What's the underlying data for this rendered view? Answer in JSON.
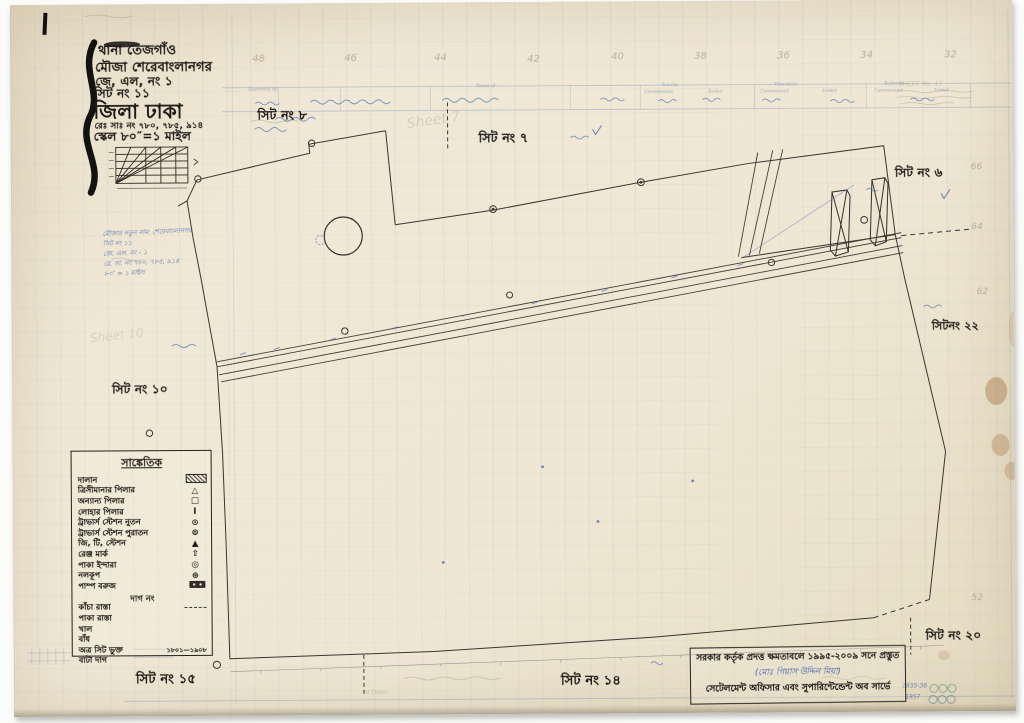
{
  "header": {
    "thana": "থানা তেজগাঁও",
    "mouza": "মৌজা শেরেবাংলানগর",
    "jl_no": "জে, এল, নং ১",
    "sheet_no": "সিট নং ১১",
    "district": "জিলা ঢাকা",
    "rs_no": "রেঃ সাঃ নং ৭৮০, ৭৮৫, ৯১৪",
    "scale": "স্কেল ৮০″=১ মাইল"
  },
  "sheet_labels": {
    "s8": "সিট নং ৮",
    "s7": "সিট নং ৭",
    "s6": "সিট নং ৬",
    "s22": "সিটনং ২২",
    "s10": "সিট নং ১০",
    "s20": "সিট নং ২০",
    "s15": "সিট নং ১৫",
    "s14": "সিট নং ১৪"
  },
  "grid_numbers": {
    "top": [
      "48",
      "46",
      "44",
      "42",
      "40",
      "38",
      "36",
      "34",
      "32"
    ],
    "right": [
      "66",
      "64",
      "62",
      "52"
    ]
  },
  "form_strip": {
    "labels": [
      "Examined by",
      "Name of",
      "Survey",
      "Khanapuri",
      "Bujharat",
      "Commenced",
      "Ended",
      "Commenced",
      "Ended",
      "Commenced",
      "Ended"
    ]
  },
  "legend": {
    "title": "সাঙ্কেতিক",
    "items": [
      {
        "label": "দালান",
        "sym": "hatch"
      },
      {
        "label": "ত্রিসীমানার পিলার",
        "sym": "△"
      },
      {
        "label": "অন্যান্য পিলার",
        "sym": "□"
      },
      {
        "label": "লোহার পিলার",
        "sym": "Ⅰ"
      },
      {
        "label": "ট্রাভার্স স্টেশন নুতন",
        "sym": "⊙"
      },
      {
        "label": "ট্রাভার্স স্টেশন পুরাতন",
        "sym": "⊚"
      },
      {
        "label": "জি, টি, স্টেশন",
        "sym": "▲"
      },
      {
        "label": "রেঞ্জ মার্ক",
        "sym": "⇧"
      },
      {
        "label": "পাকা ইন্দারা",
        "sym": "◎"
      },
      {
        "label": "নলকূপ",
        "sym": "⊛"
      },
      {
        "label": "পাম্প বরুজ",
        "sym": "pump"
      }
    ],
    "plot_heading": "দাগ নং",
    "line_items": [
      {
        "label": "কাঁচা রাস্তা",
        "value": ""
      },
      {
        "label": "পাকা রাস্তা",
        "value": ""
      },
      {
        "label": "খাল",
        "value": ""
      },
      {
        "label": "বাঁধ",
        "value": ""
      },
      {
        "label": "অত্র সিট ভুক্ত",
        "value": "১৮০১—১৯০৮"
      },
      {
        "label": "বাটা দাগ",
        "value": ""
      }
    ]
  },
  "stamp": {
    "line1": "সরকার কর্তৃক প্রদত্ত ক্ষমতাবলে ১৯৯৫-২০০৯ সনে প্রস্তুত",
    "line2": "(মোঃ গিয়াস উদ্দিন মিয়া)",
    "line3": "সেটেলমেন্ট অফিসার এবং সুপারিন্টেন্ডেন্ট অব সার্ভে"
  },
  "annotations": {
    "left_note_lines": [
      "মৌজার নতুন নাম: শেরেবাংলানগর",
      "সিট নং ১১",
      "জে. এল. নং - ১",
      "রে. সা. নং ৭৮০, ৭৮৫, ৯১৪",
      "৮০″ = ১ মাইল"
    ],
    "pencil_sheet7": "Sheet 7",
    "pencil_sheet10": "Sheet 10",
    "pencil_corner": "SHEET No. 11",
    "chains": "10 Chains",
    "year_row1": "1935-36",
    "year_row2": "1957"
  }
}
